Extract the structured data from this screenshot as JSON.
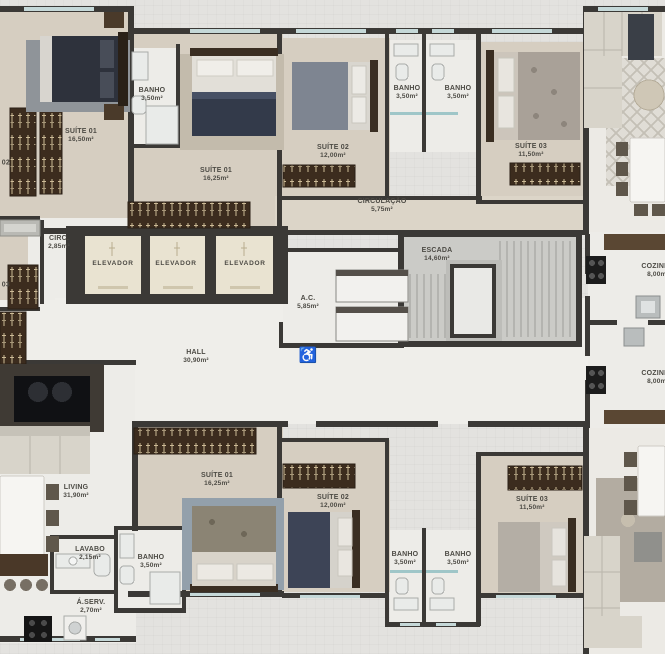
{
  "plan": {
    "name": "residential-floor-plan",
    "language": "pt-BR"
  },
  "colors": {
    "wall": "#3b3936",
    "wood_floor": "#d6cec1",
    "light_floor": "#edece8",
    "elevator_floor": "#e9e3d1",
    "stair_floor": "#cbcbc7",
    "wardrobe": "#3c2c1e",
    "window": "#c5d8d8",
    "label_text": "#4c4a44",
    "outside": "#e3e2df",
    "accent_navy": "#333a4a"
  },
  "icons": {
    "wheelchair": "♿"
  },
  "rooms": [
    {
      "id": "suite-01-top-left",
      "label": "SUÍTE 01",
      "area": "16,50m²",
      "x": 81,
      "y": 136
    },
    {
      "id": "banho-top-left",
      "label": "BANHO",
      "area": "3,50m²",
      "x": 152,
      "y": 95
    },
    {
      "id": "suite-01-top-mid",
      "label": "SUÍTE 01",
      "area": "16,25m²",
      "x": 216,
      "y": 175
    },
    {
      "id": "suite-02-top-mid",
      "label": "SUÍTE 02",
      "area": "12,00m²",
      "x": 333,
      "y": 152
    },
    {
      "id": "banho-top-1",
      "label": "BANHO",
      "area": "3,50m²",
      "x": 407,
      "y": 93
    },
    {
      "id": "banho-top-2",
      "label": "BANHO",
      "area": "3,50m²",
      "x": 458,
      "y": 93
    },
    {
      "id": "suite-03-top",
      "label": "SUÍTE 03",
      "area": "11,50m²",
      "x": 531,
      "y": 151
    },
    {
      "id": "circulacao",
      "label": "CIRCULAÇÃO",
      "area": "5,75m²",
      "x": 382,
      "y": 206
    },
    {
      "id": "suite-02-left-edge",
      "label": "SUÍTE 02",
      "area": "",
      "x": -6,
      "y": 163
    },
    {
      "id": "circ",
      "label": "CIRC.",
      "area": "2,85m²",
      "x": 59,
      "y": 243
    },
    {
      "id": "elevador-1",
      "label": "ELEVADOR",
      "area": "",
      "x": 113,
      "y": 264
    },
    {
      "id": "elevador-2",
      "label": "ELEVADOR",
      "area": "",
      "x": 176,
      "y": 264
    },
    {
      "id": "elevador-3",
      "label": "ELEVADOR",
      "area": "",
      "x": 245,
      "y": 264
    },
    {
      "id": "suite-03-left-edge",
      "label": "SUÍTE 03",
      "area": "",
      "x": -6,
      "y": 285
    },
    {
      "id": "escada",
      "label": "ESCADA",
      "area": "14,60m²",
      "x": 437,
      "y": 255
    },
    {
      "id": "ac",
      "label": "A.C.",
      "area": "5,85m²",
      "x": 308,
      "y": 303
    },
    {
      "id": "hall",
      "label": "HALL",
      "area": "30,90m²",
      "x": 196,
      "y": 357
    },
    {
      "id": "cozinha-1",
      "label": "COZINHA",
      "area": "8,00m²",
      "x": 658,
      "y": 271
    },
    {
      "id": "cozinha-2",
      "label": "COZINHA",
      "area": "8,00m²",
      "x": 658,
      "y": 378
    },
    {
      "id": "living",
      "label": "LIVING",
      "area": "31,90m²",
      "x": 76,
      "y": 492
    },
    {
      "id": "suite-01-bottom",
      "label": "SUÍTE 01",
      "area": "16,25m²",
      "x": 217,
      "y": 480
    },
    {
      "id": "suite-02-bottom",
      "label": "SUÍTE 02",
      "area": "12,00m²",
      "x": 333,
      "y": 502
    },
    {
      "id": "suite-03-bottom",
      "label": "SUÍTE 03",
      "area": "11,50m²",
      "x": 532,
      "y": 504
    },
    {
      "id": "lavabo",
      "label": "LAVABO",
      "area": "2,15m²",
      "x": 90,
      "y": 554
    },
    {
      "id": "banho-bottom-left",
      "label": "BANHO",
      "area": "3,50m²",
      "x": 151,
      "y": 562
    },
    {
      "id": "banho-bottom-1",
      "label": "BANHO",
      "area": "3,50m²",
      "x": 405,
      "y": 559
    },
    {
      "id": "banho-bottom-2",
      "label": "BANHO",
      "area": "3,50m²",
      "x": 458,
      "y": 559
    },
    {
      "id": "area-servico",
      "label": "Á.SERV.",
      "area": "2,70m²",
      "x": 91,
      "y": 607
    }
  ]
}
